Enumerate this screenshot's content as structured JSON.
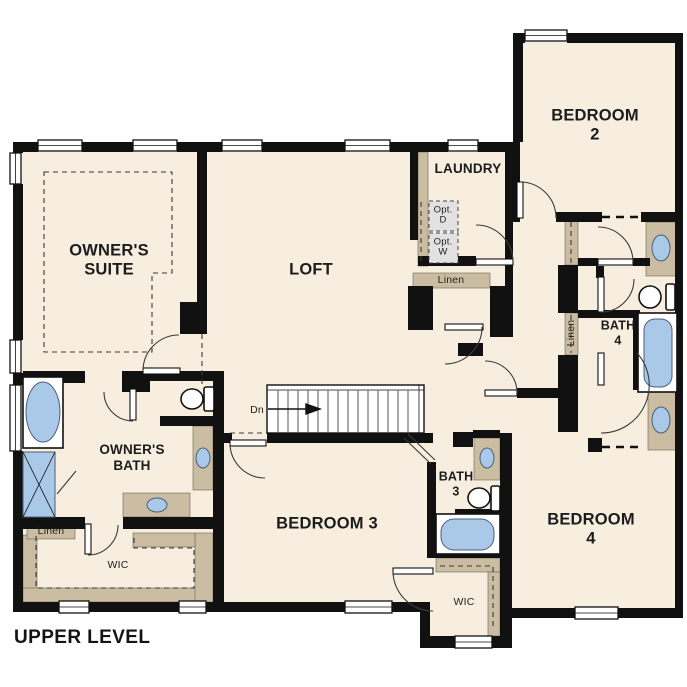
{
  "palette": {
    "background": "#ffffff",
    "floor": "#f7eedf",
    "wall": "#111111",
    "millwork_tan": "#cbbda1",
    "fixture_blue": "#aac8e8",
    "optional_gray": "#e2e2e2"
  },
  "plan": {
    "level_title": "UPPER LEVEL",
    "rooms": {
      "owners_suite": {
        "label": "OWNER'S\nSUITE"
      },
      "loft": {
        "label": "LOFT"
      },
      "laundry": {
        "label": "LAUNDRY"
      },
      "bedroom_2": {
        "label": "BEDROOM 2"
      },
      "bedroom_3": {
        "label": "BEDROOM 3"
      },
      "bedroom_4": {
        "label": "BEDROOM 4"
      },
      "owners_bath": {
        "label": "OWNER'S\nBATH"
      },
      "bath_3": {
        "label": "BATH\n3"
      },
      "bath_4": {
        "label": "BATH\n4"
      },
      "owners_wic": {
        "label": "WIC"
      },
      "bedroom_3_wic": {
        "label": "WIC"
      }
    },
    "closets": {
      "laundry_hall_linen": "Linen",
      "upstairs_hall_linen": "Linen",
      "owners_linen": "Linen"
    },
    "annotations": {
      "stair_direction": "Dn",
      "optional_dryer": "Opt.\nD",
      "optional_washer": "Opt.\nW"
    }
  }
}
